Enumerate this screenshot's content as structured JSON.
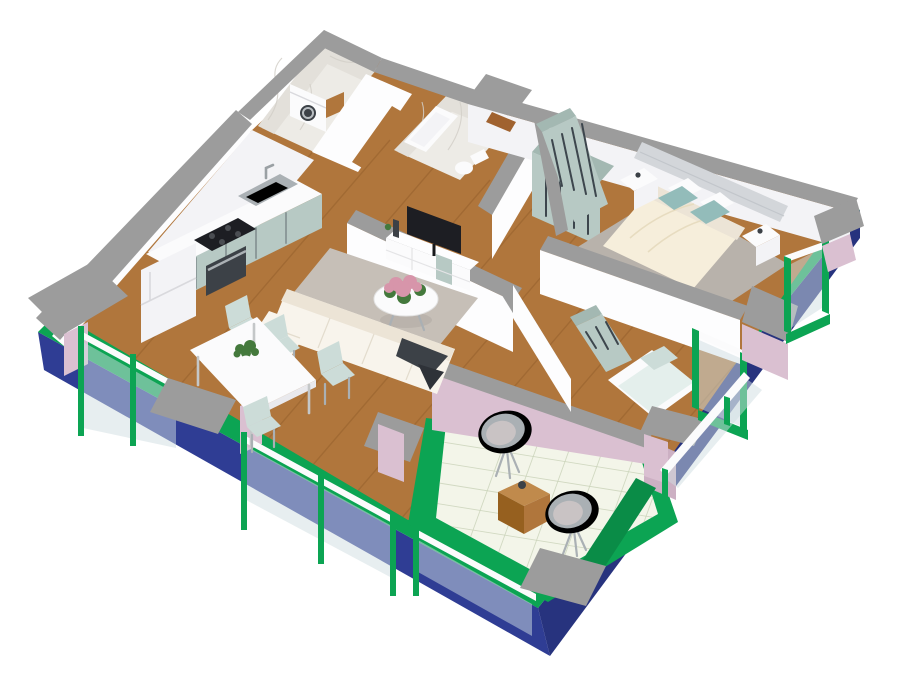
{
  "canvas": {
    "width": 900,
    "height": 689,
    "background": "#ffffff"
  },
  "view": "3d-isometric-cutaway-floor-plan",
  "colors": {
    "navy": "#2f3d94",
    "navyDark": "#27337e",
    "green": "#0ca453",
    "greenDark": "#0a8c47",
    "pink": "#dac0d1",
    "pinkDark": "#ccb0c3",
    "cap": "#9c9c9c",
    "wallWhite": "#fdfdfe",
    "wallShade": "#f3f3f6",
    "wallShade2": "#e9e9ed",
    "wood": "#b0763c",
    "woodLight": "#c08a4c",
    "woodDark": "#96601f",
    "marble": "#edebe6",
    "marbleWall": "#e3e0da",
    "marbleVein": "#d2cfc8",
    "tile": "#f3f5e9",
    "tileLine": "#c9d2b8",
    "sage": "#b7c9c4",
    "sageDark": "#a3b8b2",
    "handle": "#3d464d",
    "rug": "#c6bfb7",
    "rugBedroom": "#b8b2ab",
    "sofa": "#f8f4ec",
    "sofaShade": "#ece4d6",
    "cream": "#f6eedb",
    "teal": "#93bcba",
    "mint": "#ccdcd8",
    "mintLight": "#e4efec",
    "tvDark": "#1d1e23",
    "dark2": "#3c4147",
    "steel": "#aab0b4",
    "steelD": "#7c8288",
    "whiteFurn": "#fbfbfc",
    "glass": "#cfdde2",
    "flower": "#d795aa",
    "leaf": "#44793c",
    "headboard": "#d3d6da",
    "mat": "#a0622f",
    "plankLine": "#7c4b1d"
  },
  "scene": {
    "building": "two-bedroom apartment, cutaway axonometric render",
    "exterior": {
      "wall_color_name": "navy",
      "balcony_floor_color_name": "green",
      "parapet_accent_color_name": "pink",
      "wall_top_color_name": "gray"
    },
    "rooms": [
      {
        "name": "kitchen",
        "floor": "wood",
        "furniture": [
          "fridge",
          "kitchen-counter",
          "sink",
          "cooktop",
          "oven",
          "base-cabinets"
        ]
      },
      {
        "name": "laundry-room",
        "floor": "marble",
        "furniture": [
          "washing-machine",
          "side-counter"
        ]
      },
      {
        "name": "bathroom",
        "floor": "marble",
        "furniture": [
          "bathtub",
          "toilet"
        ]
      },
      {
        "name": "hallway",
        "floor": "wood",
        "furniture": [
          "sliding-door-wardrobe",
          "entry-doormat"
        ]
      },
      {
        "name": "living-room",
        "floor": "wood",
        "furniture": [
          "corner-sofa",
          "throw-blanket",
          "area-rug",
          "round-coffee-table",
          "flower-centerpiece",
          "tv-stand",
          "tv"
        ]
      },
      {
        "name": "dining-area",
        "floor": "wood",
        "furniture": [
          "dining-table",
          "dining-chair",
          "dining-chair",
          "dining-chair",
          "dining-chair",
          "potted-plant"
        ]
      },
      {
        "name": "master-bedroom",
        "floor": "wood",
        "furniture": [
          "double-bed",
          "pillows",
          "headboard-panel",
          "nightstand",
          "nightstand",
          "wardrobe",
          "bedroom-rug"
        ]
      },
      {
        "name": "second-bedroom",
        "floor": "wood",
        "furniture": [
          "single-bed",
          "wardrobe",
          "window"
        ]
      },
      {
        "name": "terrace",
        "floor": "tile",
        "furniture": [
          "egg-chair",
          "egg-chair",
          "wooden-cube-table"
        ]
      }
    ]
  }
}
